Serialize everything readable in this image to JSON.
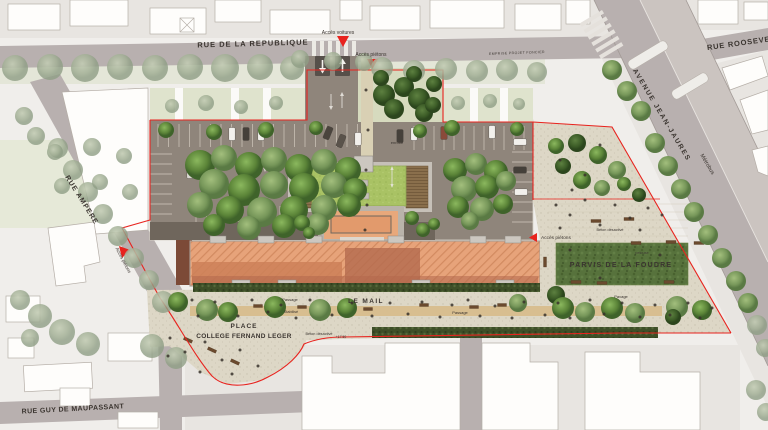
{
  "site_plan": {
    "streets": {
      "republique": "RUE DE LA REPUBLIQUE",
      "roosevelt": "RUE ROOSEVELT",
      "avenue_jean_jaures": "AVENUE JEAN-JAURES",
      "metrobus": "Métrobus",
      "ampere": "RUE AMPERE",
      "guy_maupassant": "RUE GUY DE MAUPASSANT"
    },
    "access": {
      "voitures": "Accès voitures",
      "pietons_top": "Accès piétons",
      "pietons_left": "Accès piétons",
      "pietons_right": "Accès piétons"
    },
    "places": {
      "le_mail": "LE MAIL",
      "parvis": "PARVIS DE LA FOUDRE",
      "place_line1": "PLACE",
      "place_line2": "COLLEGE FERNAND LEGER"
    },
    "materials": {
      "passage_1": "Passage",
      "passage_2": "Passage",
      "stabilise": "Stabilisé",
      "beton_mail": "Béton désactivé",
      "beton_parvis": "Béton désactivé",
      "pavage": "Pavage",
      "pelouse": "pelouse",
      "enrobe": "enrobé",
      "emprise": "EMPRISE PROJET FONCIER"
    },
    "levels": {
      "mail": "+17.50"
    },
    "palette": {
      "site_boundary_red": "#e8231e",
      "roof_salmon": "#e7a37a",
      "lawn_green": "#55703a",
      "green_roof": "#a9c264",
      "asphalt": "#8f857b",
      "street_grey": "#b8b0af",
      "paving_beige": "#dcd6c6",
      "hedge_green": "#3e4f28",
      "path_tan": "#d7bd8d"
    }
  },
  "decor": {
    "trees": [
      [
        15,
        68,
        13,
        "f"
      ],
      [
        50,
        67,
        13,
        "f"
      ],
      [
        85,
        68,
        14,
        "f"
      ],
      [
        120,
        67,
        13,
        "f"
      ],
      [
        155,
        68,
        13,
        "f"
      ],
      [
        190,
        67,
        13,
        "f"
      ],
      [
        225,
        68,
        14,
        "f"
      ],
      [
        260,
        67,
        13,
        "f"
      ],
      [
        292,
        68,
        12,
        "f"
      ],
      [
        300,
        59,
        9,
        "f"
      ],
      [
        333,
        61,
        9,
        "f"
      ],
      [
        364,
        62,
        9,
        "f"
      ],
      [
        382,
        68,
        11,
        "f"
      ],
      [
        414,
        71,
        11,
        "f"
      ],
      [
        446,
        69,
        11,
        "f"
      ],
      [
        477,
        71,
        11,
        "f"
      ],
      [
        507,
        70,
        11,
        "f"
      ],
      [
        537,
        72,
        10,
        "f"
      ],
      [
        172,
        106,
        7,
        "f"
      ],
      [
        206,
        103,
        8,
        "f"
      ],
      [
        241,
        107,
        7,
        "f"
      ],
      [
        276,
        103,
        7,
        "f"
      ],
      [
        458,
        103,
        7,
        "f"
      ],
      [
        490,
        101,
        7,
        "f"
      ],
      [
        519,
        104,
        6,
        "f"
      ],
      [
        58,
        148,
        10,
        "f"
      ],
      [
        73,
        170,
        10,
        "f"
      ],
      [
        88,
        192,
        10,
        "f"
      ],
      [
        103,
        214,
        10,
        "f"
      ],
      [
        118,
        236,
        10,
        "f"
      ],
      [
        134,
        258,
        10,
        "f"
      ],
      [
        149,
        280,
        10,
        "f"
      ],
      [
        163,
        302,
        11,
        "f"
      ],
      [
        24,
        116,
        9,
        "f"
      ],
      [
        36,
        136,
        9,
        "f"
      ],
      [
        20,
        300,
        10,
        "f"
      ],
      [
        40,
        316,
        12,
        "f"
      ],
      [
        62,
        332,
        13,
        "f"
      ],
      [
        88,
        344,
        12,
        "f"
      ],
      [
        30,
        338,
        9,
        "f"
      ],
      [
        55,
        152,
        8,
        "f"
      ],
      [
        92,
        147,
        9,
        "f"
      ],
      [
        124,
        156,
        8,
        "f"
      ],
      [
        62,
        186,
        8,
        "f"
      ],
      [
        100,
        182,
        8,
        "f"
      ],
      [
        130,
        192,
        8,
        "f"
      ],
      [
        152,
        346,
        12,
        "f"
      ],
      [
        176,
        358,
        11,
        "f"
      ],
      [
        757,
        325,
        10,
        "f"
      ],
      [
        765,
        348,
        9,
        "f"
      ],
      [
        756,
        390,
        10,
        "f"
      ],
      [
        766,
        412,
        9,
        "f"
      ],
      [
        612,
        70,
        10,
        "m"
      ],
      [
        627,
        91,
        10,
        "m"
      ],
      [
        641,
        111,
        10,
        "m"
      ],
      [
        655,
        143,
        10,
        "m"
      ],
      [
        668,
        166,
        10,
        "m"
      ],
      [
        681,
        189,
        10,
        "m"
      ],
      [
        694,
        212,
        10,
        "m"
      ],
      [
        708,
        235,
        10,
        "m"
      ],
      [
        722,
        258,
        10,
        "m"
      ],
      [
        736,
        281,
        10,
        "m"
      ],
      [
        748,
        303,
        10,
        "m"
      ],
      [
        200,
        165,
        15,
        "v"
      ],
      [
        224,
        158,
        13,
        "m"
      ],
      [
        249,
        166,
        14,
        "v"
      ],
      [
        274,
        160,
        13,
        "m"
      ],
      [
        299,
        168,
        14,
        "v"
      ],
      [
        324,
        162,
        13,
        "m"
      ],
      [
        348,
        170,
        13,
        "v"
      ],
      [
        214,
        184,
        15,
        "m"
      ],
      [
        244,
        190,
        16,
        "v"
      ],
      [
        274,
        185,
        14,
        "m"
      ],
      [
        304,
        188,
        15,
        "v"
      ],
      [
        334,
        185,
        13,
        "m"
      ],
      [
        355,
        190,
        12,
        "v"
      ],
      [
        200,
        205,
        13,
        "m"
      ],
      [
        230,
        210,
        14,
        "v"
      ],
      [
        262,
        212,
        15,
        "m"
      ],
      [
        294,
        210,
        14,
        "v"
      ],
      [
        324,
        208,
        13,
        "m"
      ],
      [
        349,
        205,
        12,
        "v"
      ],
      [
        214,
        225,
        11,
        "v"
      ],
      [
        249,
        228,
        12,
        "m"
      ],
      [
        284,
        226,
        12,
        "v"
      ],
      [
        318,
        224,
        11,
        "m"
      ],
      [
        166,
        130,
        8,
        "v"
      ],
      [
        214,
        132,
        8,
        "v"
      ],
      [
        266,
        130,
        8,
        "v"
      ],
      [
        316,
        128,
        7,
        "v"
      ],
      [
        384,
        95,
        11,
        "d"
      ],
      [
        404,
        87,
        10,
        "d"
      ],
      [
        419,
        99,
        11,
        "d"
      ],
      [
        394,
        109,
        10,
        "d"
      ],
      [
        424,
        113,
        9,
        "d"
      ],
      [
        381,
        78,
        8,
        "d"
      ],
      [
        414,
        74,
        8,
        "d"
      ],
      [
        434,
        84,
        8,
        "d"
      ],
      [
        433,
        105,
        8,
        "d"
      ],
      [
        455,
        170,
        12,
        "v"
      ],
      [
        476,
        164,
        11,
        "m"
      ],
      [
        496,
        172,
        12,
        "v"
      ],
      [
        464,
        189,
        13,
        "m"
      ],
      [
        487,
        187,
        12,
        "v"
      ],
      [
        506,
        181,
        10,
        "m"
      ],
      [
        458,
        207,
        11,
        "v"
      ],
      [
        482,
        209,
        12,
        "m"
      ],
      [
        503,
        204,
        10,
        "v"
      ],
      [
        470,
        221,
        9,
        "m"
      ],
      [
        420,
        131,
        7,
        "v"
      ],
      [
        452,
        128,
        8,
        "v"
      ],
      [
        517,
        129,
        7,
        "v"
      ],
      [
        302,
        223,
        8,
        "v"
      ],
      [
        309,
        233,
        6,
        "v"
      ],
      [
        412,
        218,
        7,
        "v"
      ],
      [
        423,
        230,
        7,
        "v"
      ],
      [
        434,
        224,
        6,
        "v"
      ],
      [
        556,
        146,
        8,
        "v"
      ],
      [
        577,
        143,
        9,
        "d"
      ],
      [
        598,
        155,
        9,
        "v"
      ],
      [
        617,
        170,
        9,
        "m"
      ],
      [
        563,
        166,
        8,
        "d"
      ],
      [
        582,
        180,
        9,
        "v"
      ],
      [
        602,
        188,
        8,
        "m"
      ],
      [
        624,
        184,
        7,
        "v"
      ],
      [
        639,
        195,
        7,
        "d"
      ],
      [
        178,
        302,
        10,
        "v"
      ],
      [
        207,
        310,
        11,
        "m"
      ],
      [
        228,
        312,
        10,
        "v"
      ],
      [
        275,
        307,
        11,
        "v"
      ],
      [
        320,
        310,
        11,
        "m"
      ],
      [
        347,
        308,
        10,
        "v"
      ],
      [
        518,
        303,
        9,
        "m"
      ],
      [
        556,
        295,
        9,
        "d"
      ],
      [
        563,
        308,
        11,
        "v"
      ],
      [
        585,
        312,
        10,
        "m"
      ],
      [
        612,
        308,
        11,
        "v"
      ],
      [
        635,
        313,
        10,
        "m"
      ],
      [
        677,
        307,
        11,
        "m"
      ],
      [
        702,
        310,
        10,
        "v"
      ],
      [
        673,
        317,
        8,
        "d"
      ]
    ],
    "cars": [
      [
        232,
        134,
        0,
        "#f2f0ec"
      ],
      [
        246,
        134,
        0,
        "#45403a"
      ],
      [
        261,
        134,
        0,
        "#f2f0ec"
      ],
      [
        190,
        172,
        0,
        "#dcd9d3"
      ],
      [
        328,
        133,
        22,
        "#4a443d"
      ],
      [
        341,
        141,
        22,
        "#5a534b"
      ],
      [
        358,
        139,
        0,
        "#f2f0ec"
      ],
      [
        400,
        136,
        0,
        "#45403a"
      ],
      [
        414,
        134,
        0,
        "#f2f0ec"
      ],
      [
        444,
        133,
        0,
        "#8a4a3a"
      ],
      [
        492,
        132,
        0,
        "#f2f0ec"
      ],
      [
        520,
        142,
        90,
        "#f2f0ec"
      ],
      [
        520,
        170,
        90,
        "#45403a"
      ],
      [
        521,
        192,
        90,
        "#f2f0ec"
      ],
      [
        250,
        229,
        90,
        "#3c3733"
      ]
    ],
    "benches": [
      [
        258,
        306,
        9,
        3,
        0
      ],
      [
        302,
        307,
        9,
        3,
        0
      ],
      [
        368,
        309,
        9,
        3,
        0
      ],
      [
        424,
        305,
        9,
        3,
        0
      ],
      [
        474,
        307,
        9,
        3,
        0
      ],
      [
        502,
        305,
        9,
        3,
        0
      ],
      [
        596,
        221,
        10,
        3,
        0
      ],
      [
        629,
        219,
        10,
        3,
        0
      ],
      [
        636,
        243,
        10,
        3,
        0
      ],
      [
        671,
        242,
        10,
        3,
        0
      ],
      [
        699,
        243,
        10,
        3,
        0
      ],
      [
        576,
        282,
        10,
        3,
        0
      ],
      [
        602,
        283,
        10,
        3,
        0
      ],
      [
        669,
        282,
        10,
        3,
        0
      ],
      [
        545,
        262,
        3,
        10,
        0
      ],
      [
        212,
        350,
        9,
        3,
        25
      ],
      [
        235,
        362,
        9,
        3,
        25
      ],
      [
        188,
        340,
        9,
        3,
        25
      ]
    ],
    "people": [
      [
        192,
        300
      ],
      [
        198,
        316
      ],
      [
        215,
        302
      ],
      [
        238,
        316
      ],
      [
        252,
        300
      ],
      [
        268,
        312
      ],
      [
        281,
        305
      ],
      [
        296,
        318
      ],
      [
        310,
        300
      ],
      [
        332,
        315
      ],
      [
        352,
        303
      ],
      [
        372,
        316
      ],
      [
        390,
        303
      ],
      [
        408,
        314
      ],
      [
        422,
        302
      ],
      [
        440,
        317
      ],
      [
        452,
        305
      ],
      [
        468,
        300
      ],
      [
        480,
        316
      ],
      [
        495,
        306
      ],
      [
        512,
        318
      ],
      [
        524,
        302
      ],
      [
        545,
        315
      ],
      [
        558,
        303
      ],
      [
        570,
        318
      ],
      [
        590,
        300
      ],
      [
        604,
        314
      ],
      [
        622,
        303
      ],
      [
        640,
        317
      ],
      [
        655,
        305
      ],
      [
        670,
        315
      ],
      [
        688,
        303
      ],
      [
        700,
        318
      ],
      [
        712,
        308
      ],
      [
        556,
        205
      ],
      [
        570,
        215
      ],
      [
        585,
        200
      ],
      [
        600,
        225
      ],
      [
        615,
        205
      ],
      [
        630,
        218
      ],
      [
        648,
        208
      ],
      [
        560,
        228
      ],
      [
        640,
        230
      ],
      [
        662,
        215
      ],
      [
        570,
        250
      ],
      [
        660,
        255
      ],
      [
        600,
        278
      ],
      [
        170,
        338
      ],
      [
        185,
        352
      ],
      [
        205,
        342
      ],
      [
        222,
        360
      ],
      [
        240,
        350
      ],
      [
        258,
        366
      ],
      [
        200,
        372
      ],
      [
        232,
        374
      ],
      [
        168,
        356
      ],
      [
        366,
        90
      ],
      [
        368,
        130
      ],
      [
        366,
        170
      ],
      [
        367,
        205
      ],
      [
        365,
        230
      ],
      [
        560,
        160
      ],
      [
        585,
        175
      ],
      [
        572,
        190
      ],
      [
        600,
        145
      ]
    ]
  }
}
